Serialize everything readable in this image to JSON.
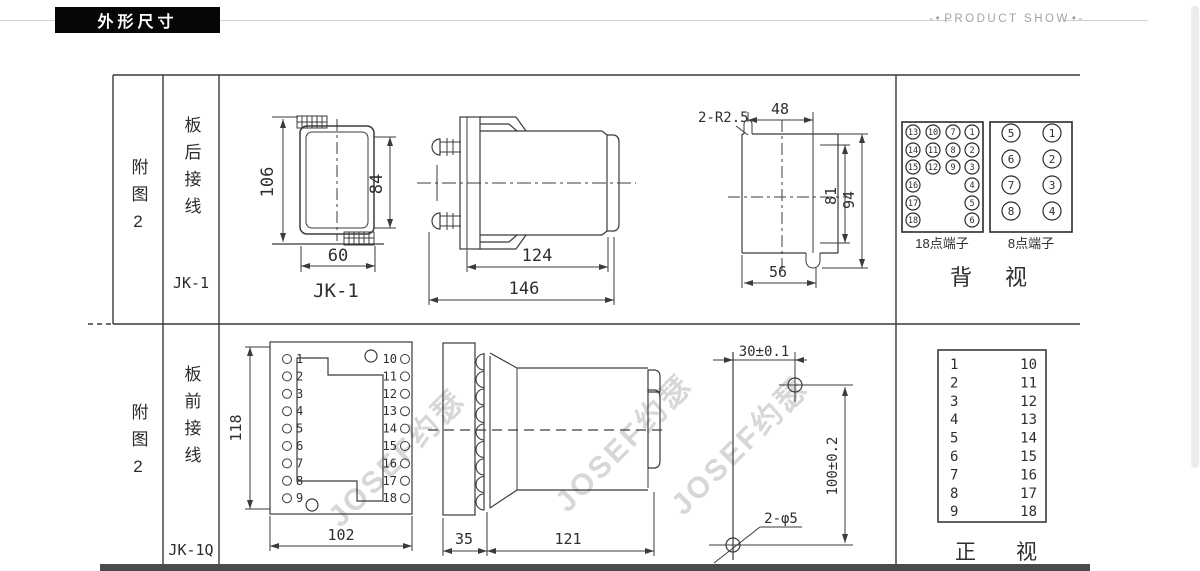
{
  "header": {
    "title": "外形尺寸",
    "ps_left": "-•",
    "ps_text": "PRODUCT SHOW",
    "ps_right": "•-"
  },
  "rows": [
    {
      "fig": "附图2",
      "wiring": "板后接线",
      "model": "JK-1"
    },
    {
      "fig": "附图2",
      "wiring": "板前接线",
      "model": "JK-1Q"
    }
  ],
  "jk1_front": {
    "dim_h": "106",
    "dim_inner": "84",
    "dim_w": "60",
    "label": "JK-1"
  },
  "jk1_side": {
    "dim_body": "124",
    "dim_total": "146"
  },
  "cutout": {
    "slot_label": "2-R2.5",
    "dim_top": "48",
    "dim_h1": "81",
    "dim_h2": "94",
    "dim_w": "56"
  },
  "rear_view": {
    "t18": {
      "colA": [
        "13",
        "14",
        "15",
        "16",
        "17",
        "18"
      ],
      "colB": [
        "10",
        "11",
        "12"
      ],
      "colC": [
        "7",
        "8",
        "9"
      ],
      "colD": [
        "1",
        "2",
        "3",
        "4",
        "5",
        "6"
      ],
      "label": "18点端子"
    },
    "t8": {
      "colL": [
        "5",
        "6",
        "7",
        "8"
      ],
      "colR": [
        "1",
        "2",
        "3",
        "4"
      ],
      "label": "8点端子"
    },
    "title": "背视"
  },
  "jk1q_front": {
    "dim_h": "118",
    "dim_w": "102",
    "left": [
      "1",
      "2",
      "3",
      "4",
      "5",
      "6",
      "7",
      "8",
      "9"
    ],
    "right": [
      "10",
      "11",
      "12",
      "13",
      "14",
      "15",
      "16",
      "17",
      "18"
    ]
  },
  "jk1q_side": {
    "dim_front": "35",
    "dim_body": "121"
  },
  "drill": {
    "dim_top": "30±0.1",
    "dim_v": "100±0.2",
    "holes_label": "2-φ5"
  },
  "front_table": {
    "left": [
      "1",
      "2",
      "3",
      "4",
      "5",
      "6",
      "7",
      "8",
      "9"
    ],
    "right": [
      "10",
      "11",
      "12",
      "13",
      "14",
      "15",
      "16",
      "17",
      "18"
    ],
    "title": "正视"
  },
  "watermark": {
    "text": "JOSEF约瑟"
  }
}
